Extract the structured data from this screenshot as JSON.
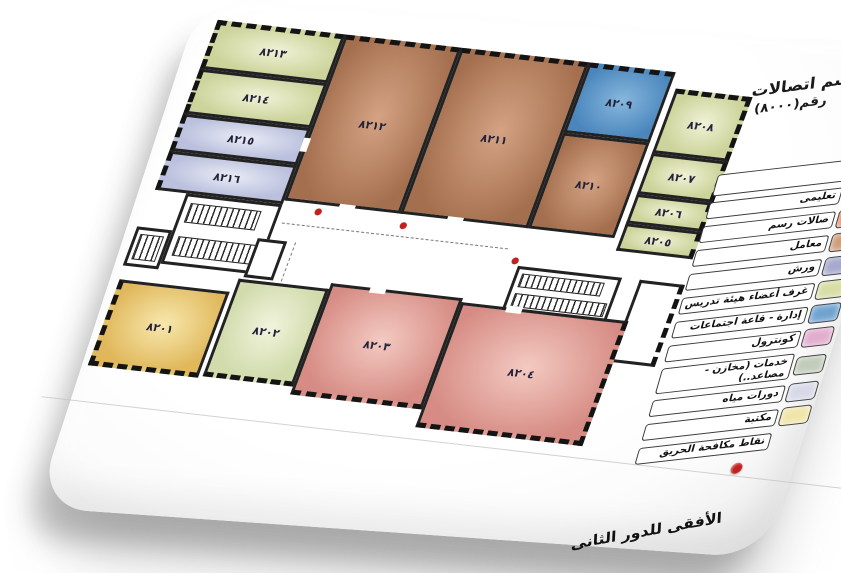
{
  "title": {
    "line1": "قسم اتصالات",
    "line2": "رقم(٨٠٠٠)"
  },
  "floor_label": "الأفقى للدور الثانى",
  "rooms": [
    {
      "id": "8201",
      "label": "٨٢٠١",
      "fill": "#e0b75a"
    },
    {
      "id": "8202",
      "label": "٨٢٠٢",
      "fill": "#d1dbac"
    },
    {
      "id": "8203",
      "label": "٨٢٠٣",
      "fill": "#d68c84"
    },
    {
      "id": "8204",
      "label": "٨٢٠٤",
      "fill": "#d68c84"
    },
    {
      "id": "8205",
      "label": "٨٢٠٥",
      "fill": "#ccd49b"
    },
    {
      "id": "8206",
      "label": "٨٢٠٦",
      "fill": "#ccd49b"
    },
    {
      "id": "8207",
      "label": "٨٢٠٧",
      "fill": "#ccd49b"
    },
    {
      "id": "8208",
      "label": "٨٢٠٨",
      "fill": "#ccd49b"
    },
    {
      "id": "8209",
      "label": "٨٢٠٩",
      "fill": "#4a86bd"
    },
    {
      "id": "8210",
      "label": "٨٢١٠",
      "fill": "#a46f4e"
    },
    {
      "id": "8211",
      "label": "٨٢١١",
      "fill": "#a46f4e"
    },
    {
      "id": "8212",
      "label": "٨٢١٢",
      "fill": "#a46f4e"
    },
    {
      "id": "8213",
      "label": "٨٢١٣",
      "fill": "#ccd49b"
    },
    {
      "id": "8214",
      "label": "٨٢١٤",
      "fill": "#ccd49b"
    },
    {
      "id": "8215",
      "label": "٨٢١٥",
      "fill": "#bac0dd"
    },
    {
      "id": "8216",
      "label": "٨٢١٦",
      "fill": "#bac0dd"
    }
  ],
  "legend": {
    "items": [
      {
        "label": "تعليمى",
        "color": "#e09190"
      },
      {
        "label": "صالات رسم",
        "color": "#dd9275"
      },
      {
        "label": "معامل",
        "color": "#cb9d7b"
      },
      {
        "label": "ورش",
        "color": "#a6a9cd"
      },
      {
        "label": "غرف أعضاء هيئة تدريس",
        "color": "#d7dda5"
      },
      {
        "label": "إدارة - قاعة اجتماعات",
        "color": "#6fa3d0"
      },
      {
        "label": "كونترول",
        "color": "#e2adcf"
      },
      {
        "label": "خدمات (مخازن - مصاعد..)",
        "color": "#c1ccba"
      },
      {
        "label": "دورات مياه",
        "color": "#d7d9e7"
      },
      {
        "label": "مكتبة",
        "color": "#f0e5aa"
      }
    ],
    "fire_label": "نقاط مكافحة الحريق",
    "fire_color": "#c32120"
  }
}
